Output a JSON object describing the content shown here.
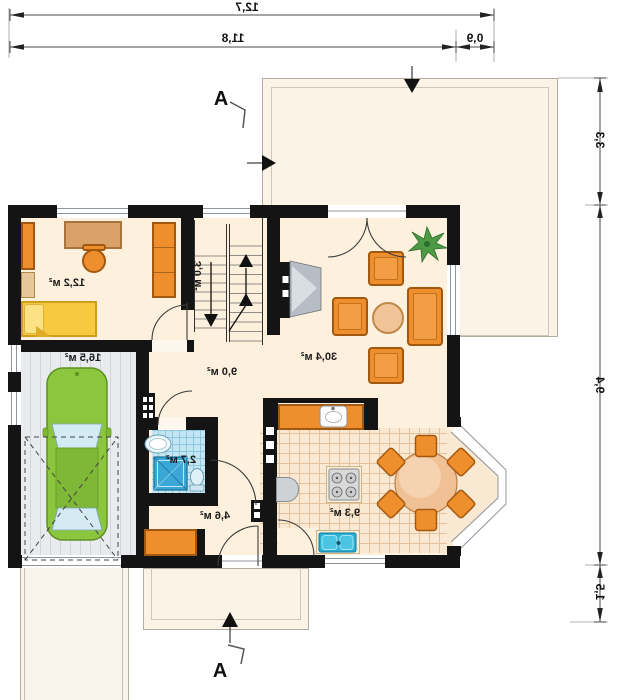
{
  "plan_title": "house ground floor plan (mirrored)",
  "dimensions": {
    "total_width": "12,7",
    "main_width": "11,8",
    "side_width": "0,9",
    "right_upper": "3,3",
    "right_main": "9,4",
    "right_lower": "1,5"
  },
  "section_marks": {
    "top": "A",
    "bottom": "A"
  },
  "rooms": {
    "office": {
      "area": "12,2 м²"
    },
    "garage": {
      "area": "16,5 м²"
    },
    "staircase": {
      "area": "3,0 м²"
    },
    "hall": {
      "area": "9,0 м²"
    },
    "living_room": {
      "area": "30,4 м²"
    },
    "bathroom": {
      "area": "2,7 м²"
    },
    "entrance_hall": {
      "area": "4,6 м²"
    },
    "kitchen": {
      "area": "9,3 м²"
    }
  },
  "colors": {
    "wall": "#141414",
    "floor": "#fdf0dd",
    "terrace": "#fcf3e7",
    "kitchen_tile": "#f9e8d2",
    "bath_tile": "#c3e6f2",
    "furniture_orange": "#ee8e2d",
    "wood": "#d9a268",
    "bed_yellow": "#f6c93e",
    "car_green": "#8cc63f",
    "water_blue": "#29b2d6"
  }
}
